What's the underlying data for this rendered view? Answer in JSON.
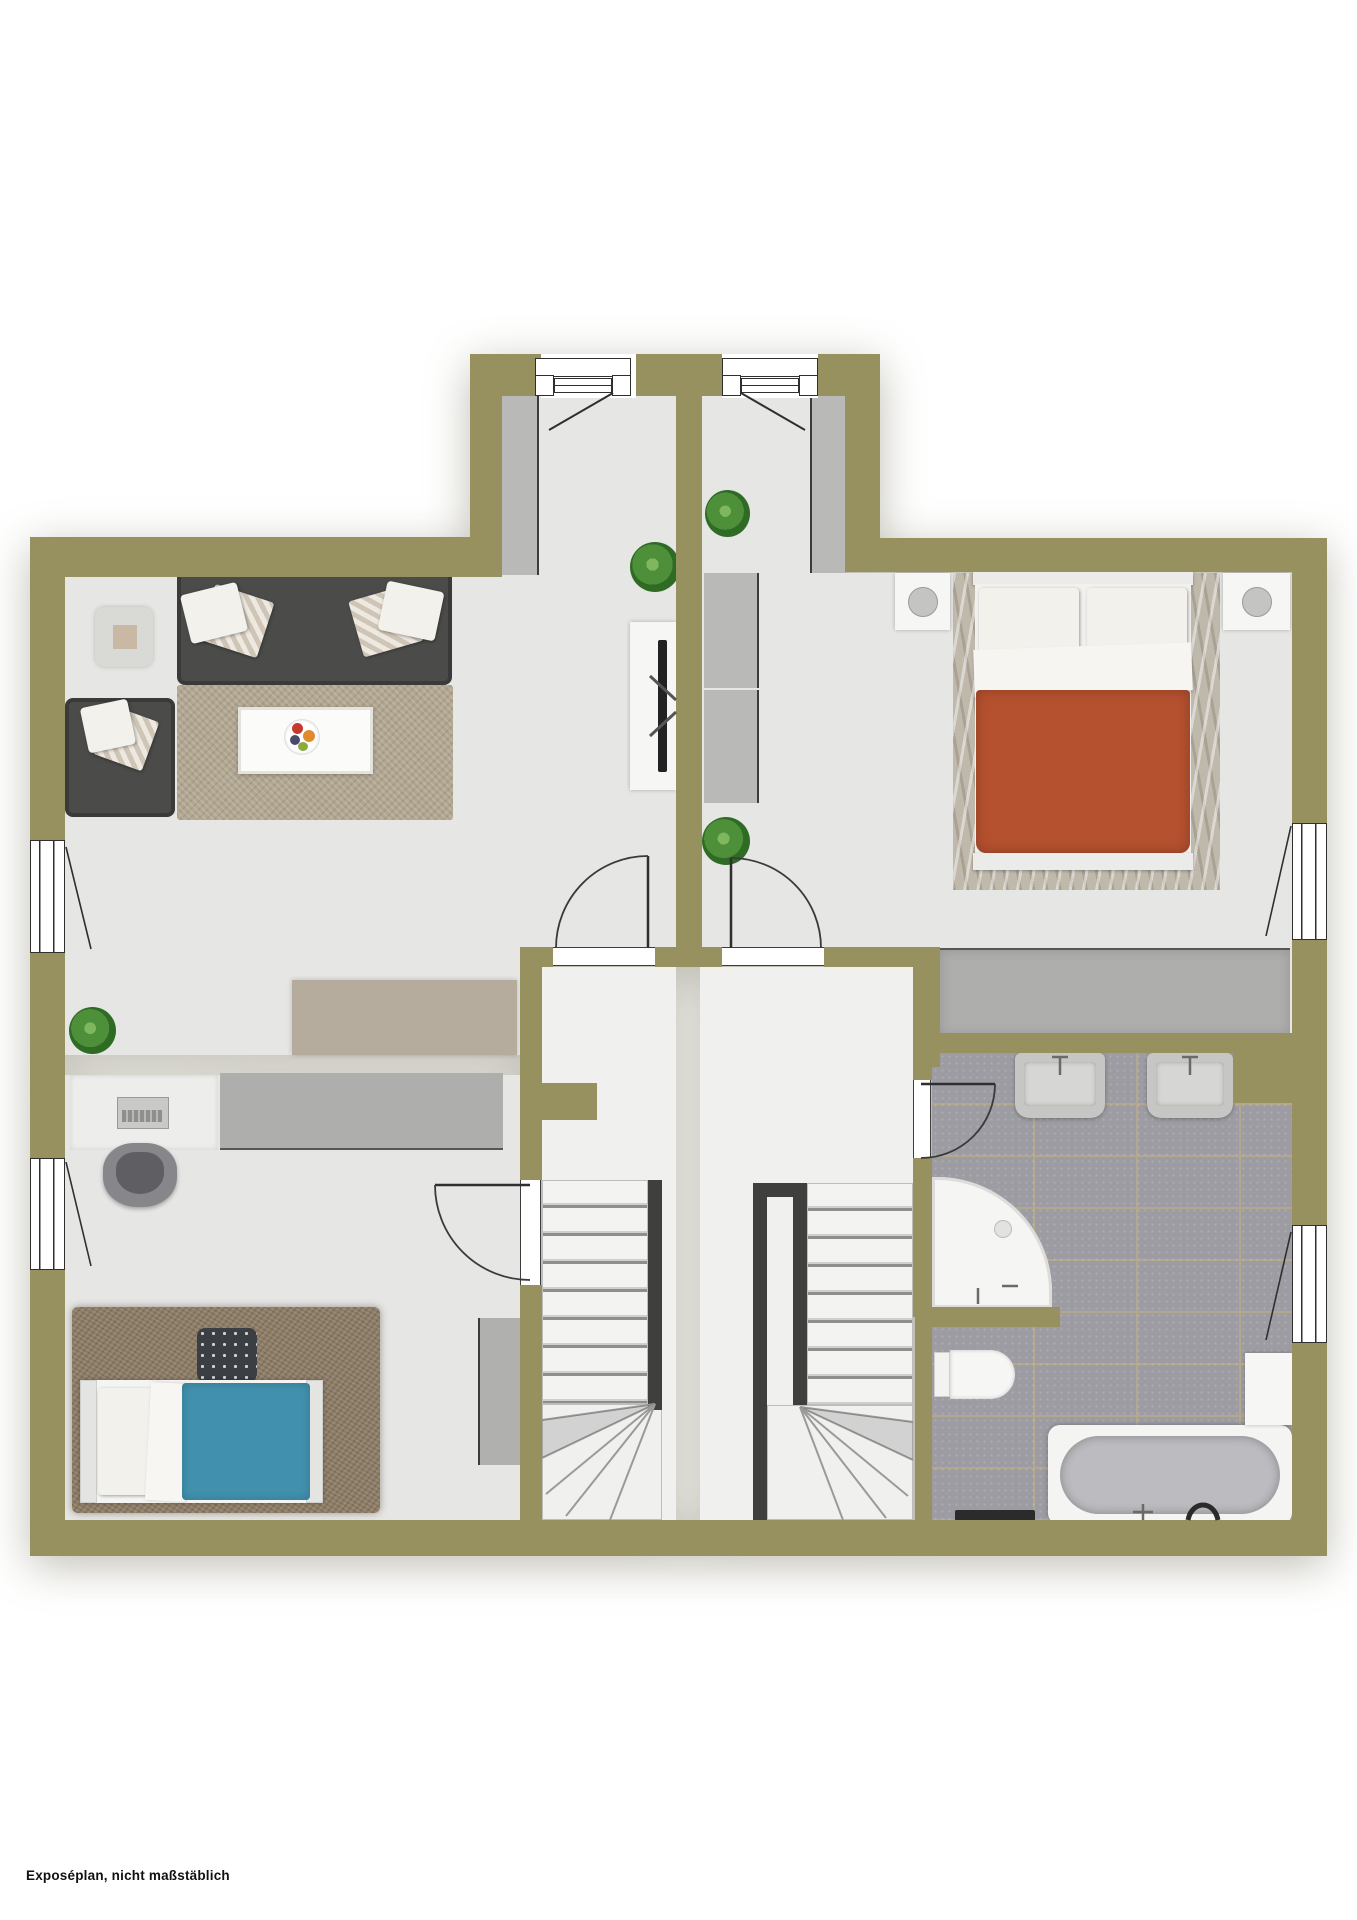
{
  "meta": {
    "footnote": "Exposéplan, nicht maßstäblich"
  },
  "theme": {
    "wall": "#97905f",
    "floor": "#e6e6e4",
    "tile": "#9c9ca2",
    "grout": "#b4a88c",
    "gray-f": "#b9b9b7",
    "gray-d": "#aeaeac",
    "white-f": "#f6f6f4",
    "sofa": "#4b4b49",
    "tan": "#b6ac9d",
    "rug-living": "#b1a690",
    "rug-bed": "#bfb9ac",
    "rug-kids": "#8d7c65",
    "blue": "#4191ae",
    "red": "#b5512f",
    "rail": "#3f3f3d",
    "plant": "#4e8f3a"
  },
  "plan": {
    "type": "floorplan-two-unit",
    "rooms": [
      {
        "name": "entry-hall-left",
        "furniture": [
          "wardrobe",
          "tv-sideboard",
          "plant"
        ]
      },
      {
        "name": "entry-hall-right",
        "furniture": [
          "wardrobe",
          "plant",
          "plant"
        ]
      },
      {
        "name": "living-room",
        "furniture": [
          "corner-sofa",
          "loveseat",
          "side-table",
          "coffee-table",
          "fruit-bowl",
          "rug",
          "lowboard",
          "plant"
        ]
      },
      {
        "name": "bedroom",
        "furniture": [
          "double-bed-red",
          "nightstand-left",
          "nightstand-right",
          "wardrobe",
          "dresser",
          "rug"
        ]
      },
      {
        "name": "kids-room",
        "furniture": [
          "single-bed-blue",
          "desk",
          "laptop",
          "desk-chair",
          "sideboard",
          "tall-cabinet",
          "pouf",
          "rug"
        ]
      },
      {
        "name": "stair-hall-left",
        "furniture": [
          "staircase",
          "closet-door"
        ]
      },
      {
        "name": "stair-hall-right",
        "furniture": [
          "staircase",
          "closet"
        ]
      },
      {
        "name": "bathroom",
        "furniture": [
          "sink",
          "sink",
          "corner-shower",
          "toilet",
          "bathtub",
          "towel-bench",
          "cabinet"
        ]
      }
    ],
    "doors": [
      "entry-door-left",
      "entry-door-right",
      "hall-door-left",
      "hall-door-right",
      "kids-room-door",
      "bathroom-door"
    ],
    "windows": [
      "living-room-window",
      "kids-room-window",
      "bedroom-window",
      "bathroom-window"
    ]
  }
}
